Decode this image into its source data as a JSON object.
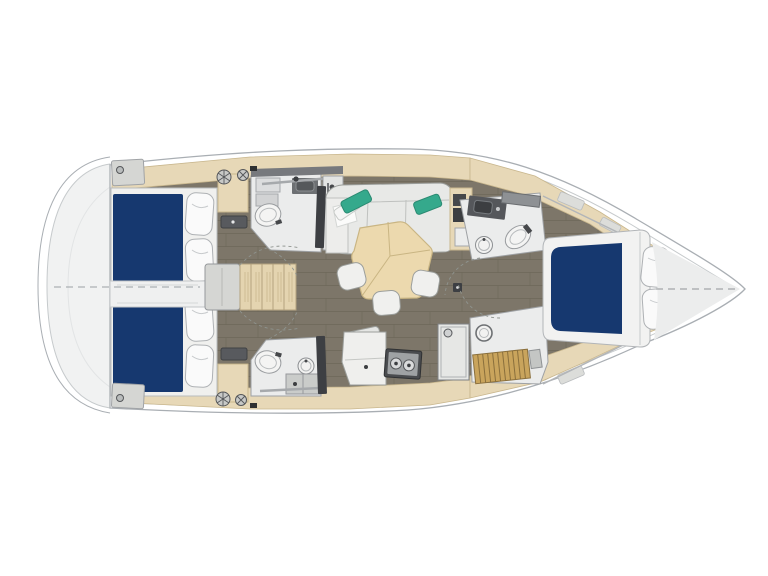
{
  "page": {
    "title": "Sailing yacht interior layout plan — top view",
    "background": "#ffffff"
  },
  "palette": {
    "hull-line": "#a9aeb3",
    "inner-line": "#c6cacc",
    "platform-fill": "#f1f2f2",
    "mattress-blue": "#16386f",
    "floor-wood": "#7d7669",
    "floor-seam": "#5e594c",
    "trim-beige": "#e7d8b7",
    "trim-line": "#c9b78e",
    "furn-white": "#f0f0ee",
    "furn-line": "#9b9e9b",
    "room-floor": "#ebecec",
    "counter-dark": "#55575b",
    "metal": "#a6a9ac",
    "teal": "#35a98c",
    "teak": "#c9a45c",
    "teak-line": "#8a6f3c",
    "step-beige": "#e4d4b0",
    "dark-panel": "#3d3f43",
    "gray-box": "#d5d6d3",
    "table-beige": "#ecd9ae",
    "table-line": "#c9b583",
    "pillow-white": "#fafafa"
  },
  "areas": [
    {
      "id": "swim-platform",
      "label": "Swim platform"
    },
    {
      "id": "aft-cabin-port",
      "label": "Aft double cabin (port)"
    },
    {
      "id": "aft-cabin-starboard",
      "label": "Aft double cabin (starboard)"
    },
    {
      "id": "companionway",
      "label": "Companionway steps"
    },
    {
      "id": "head-port",
      "label": "Port bathroom with shower"
    },
    {
      "id": "head-starboard",
      "label": "Starboard bathroom with shower"
    },
    {
      "id": "saloon",
      "label": "Saloon with L-sofa, table and stools"
    },
    {
      "id": "galley",
      "label": "Galley with stove and counters"
    },
    {
      "id": "forward-head",
      "label": "Forward bathroom"
    },
    {
      "id": "forward-shower",
      "label": "Forward shower with teak grate"
    },
    {
      "id": "forward-cabin",
      "label": "Forward double cabin"
    },
    {
      "id": "bow-locker",
      "label": "Bow locker"
    }
  ]
}
